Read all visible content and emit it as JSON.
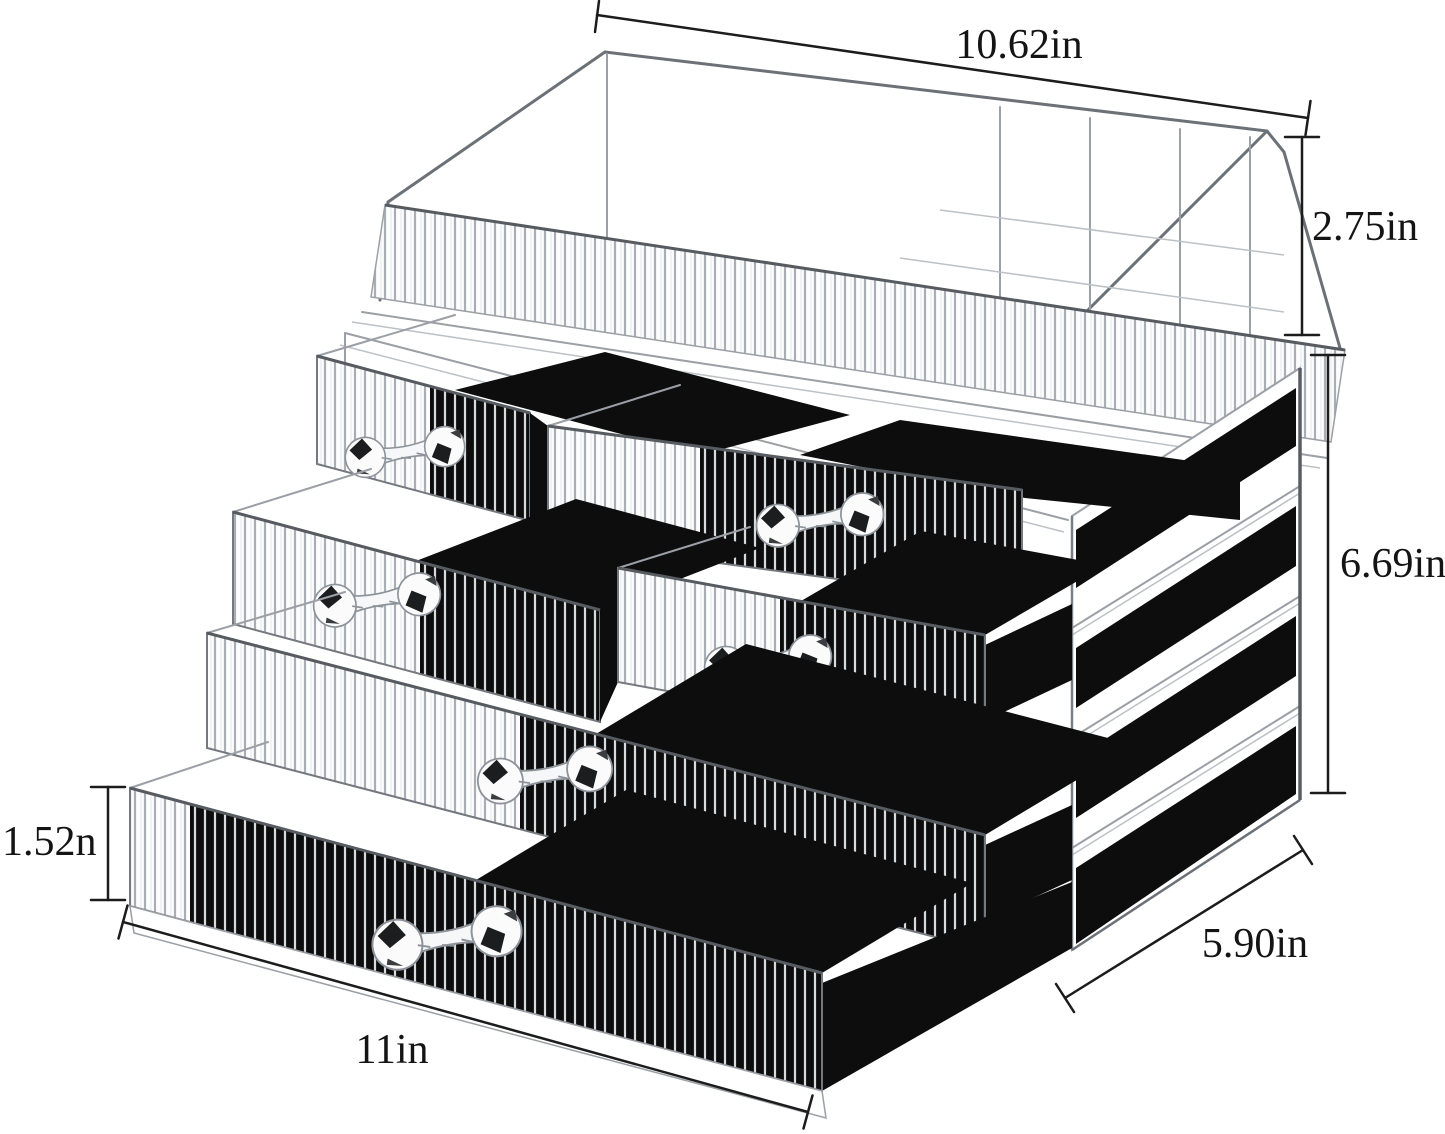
{
  "meta": {
    "image_type": "product-dimension-diagram",
    "subject": "clear acrylic cosmetic organizer with drawers and top lipstick tray"
  },
  "dimensions": {
    "top_width": "10.62in",
    "tray_height": "2.75in",
    "unit_height": "6.69in",
    "drawer_height": "1.52n",
    "bottom_width": "11in",
    "depth": "5.90in"
  },
  "product": {
    "top_tray": "open tray with lipstick compartment grid",
    "small_drawers_visible": 4,
    "large_drawers_visible": 2,
    "knob_style": "crystal-bow-knob",
    "front_texture": "vertical ribbed acrylic",
    "interior_color_name": "black"
  },
  "colors": {
    "background": "#ffffff",
    "dimension_line": "#1c1c1c",
    "label_text": "#141414",
    "acrylic_edge": "#9ba0a7",
    "interior_black": "#0d0d0e"
  }
}
